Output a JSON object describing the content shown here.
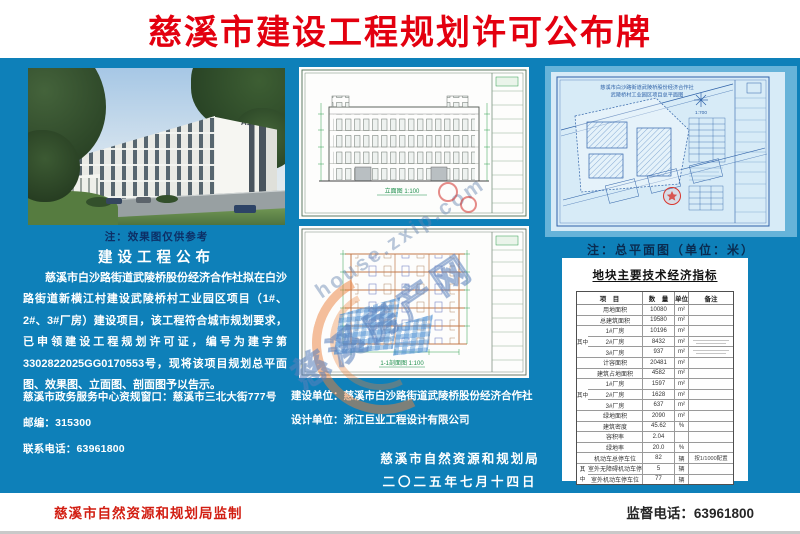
{
  "colors": {
    "background_blue": "#0e80b9",
    "title_red": "#e3000f",
    "footer_red": "#d21e12",
    "note_navy": "#0d2f66",
    "blueprint_paper": "#d7ebf7",
    "blueprint_line": "#2f62a8",
    "drawing_green": "#2f9e4f",
    "section_orange": "#c2794a"
  },
  "header": {
    "title": "慈溪市建设工程规划许可公布牌"
  },
  "left": {
    "photo_label": "A1",
    "photo_note": "注：效果图仅供参考",
    "announce_title": "建设工程公布",
    "announce_body": "慈溪市白沙路街道武陵桥股份经济合作社拟在白沙路街道新横江村建设武陵桥村工业园区项目（1#、2#、3#厂房）建设项目，该工程符合城市规划要求，已申领建设工程规划许可证，编号为建字第3302822025GG0170553号，现将该项目规划总平面图、效果图、立面图、剖面图予以告示。",
    "service_window": "慈溪市政务服务中心资规窗口：慈溪市三北大街777号",
    "postcode_line": "邮编：315300",
    "phone_line": "联系电话：63961800"
  },
  "middle": {
    "elevation_caption": "立面图 1:100",
    "section_caption": "1-1剖面图 1:100",
    "builder": "建设单位：慈溪市白沙路街道武陵桥股份经济合作社",
    "designer": "设计单位：浙江巨业工程设计有限公司",
    "agency": "慈溪市自然资源和规划局",
    "date": "二〇二五年七月十四日"
  },
  "right": {
    "plan_title_1": "慈溪市白沙路街道武陵桥股份经济合作社",
    "plan_title_2": "武陵桥村工业园区项目总平面图",
    "plan_scale": "1:700",
    "plan_note": "注：总平面图（单位：米）",
    "indicators": {
      "title": "地块主要技术经济指标",
      "header": {
        "item": "项　目",
        "qty": "数　量",
        "unit": "单位",
        "remark": "备注"
      },
      "rows": [
        {
          "g": "",
          "gk": "",
          "item": "用地面积",
          "qty": "10080",
          "unit": "m²",
          "remark": "",
          "rmk": ""
        },
        {
          "g": "",
          "gk": "",
          "item": "总建筑面积",
          "qty": "19580",
          "unit": "m²",
          "remark": "",
          "rmk": ""
        },
        {
          "g": "",
          "gk": "top",
          "item": "1#厂房",
          "qty": "10196",
          "unit": "m²",
          "remark": "",
          "rmk": ""
        },
        {
          "g": "其中",
          "gk": "mid",
          "item": "2#厂房",
          "qty": "8432",
          "unit": "m²",
          "remark": "",
          "rmk": "lines"
        },
        {
          "g": "",
          "gk": "bot",
          "item": "3#厂房",
          "qty": "937",
          "unit": "m²",
          "remark": "",
          "rmk": "lines"
        },
        {
          "g": "",
          "gk": "",
          "item": "计容面积",
          "qty": "20481",
          "unit": "m²",
          "remark": "",
          "rmk": ""
        },
        {
          "g": "",
          "gk": "",
          "item": "建筑占地面积",
          "qty": "4582",
          "unit": "m²",
          "remark": "",
          "rmk": ""
        },
        {
          "g": "",
          "gk": "top",
          "item": "1#厂房",
          "qty": "1597",
          "unit": "m²",
          "remark": "",
          "rmk": ""
        },
        {
          "g": "其中",
          "gk": "mid",
          "item": "2#厂房",
          "qty": "1628",
          "unit": "m²",
          "remark": "",
          "rmk": ""
        },
        {
          "g": "",
          "gk": "bot",
          "item": "3#厂房",
          "qty": "637",
          "unit": "m²",
          "remark": "",
          "rmk": ""
        },
        {
          "g": "",
          "gk": "",
          "item": "绿地面积",
          "qty": "2090",
          "unit": "m²",
          "remark": "",
          "rmk": ""
        },
        {
          "g": "",
          "gk": "",
          "item": "建筑密度",
          "qty": "45.62",
          "unit": "%",
          "remark": "",
          "rmk": ""
        },
        {
          "g": "",
          "gk": "",
          "item": "容积率",
          "qty": "2.04",
          "unit": "",
          "remark": "",
          "rmk": ""
        },
        {
          "g": "",
          "gk": "",
          "item": "绿地率",
          "qty": "20.0",
          "unit": "%",
          "remark": "",
          "rmk": ""
        },
        {
          "g": "",
          "gk": "",
          "item": "机动车总停车位",
          "qty": "82",
          "unit": "辆",
          "remark": "按1/1000配置",
          "rmk": ""
        },
        {
          "g": "其",
          "gk": "top2",
          "item": "室外无障碍机动车停车位",
          "qty": "5",
          "unit": "辆",
          "remark": "",
          "rmk": ""
        },
        {
          "g": "中",
          "gk": "bot2",
          "item": "室外机动车停车位",
          "qty": "77",
          "unit": "辆",
          "remark": "",
          "rmk": ""
        }
      ]
    }
  },
  "footer": {
    "left": "慈溪市自然资源和规划局监制",
    "right": "监督电话：63961800"
  },
  "watermark": {
    "url": "house.zxip.com",
    "cn": "慈溪房产网"
  }
}
